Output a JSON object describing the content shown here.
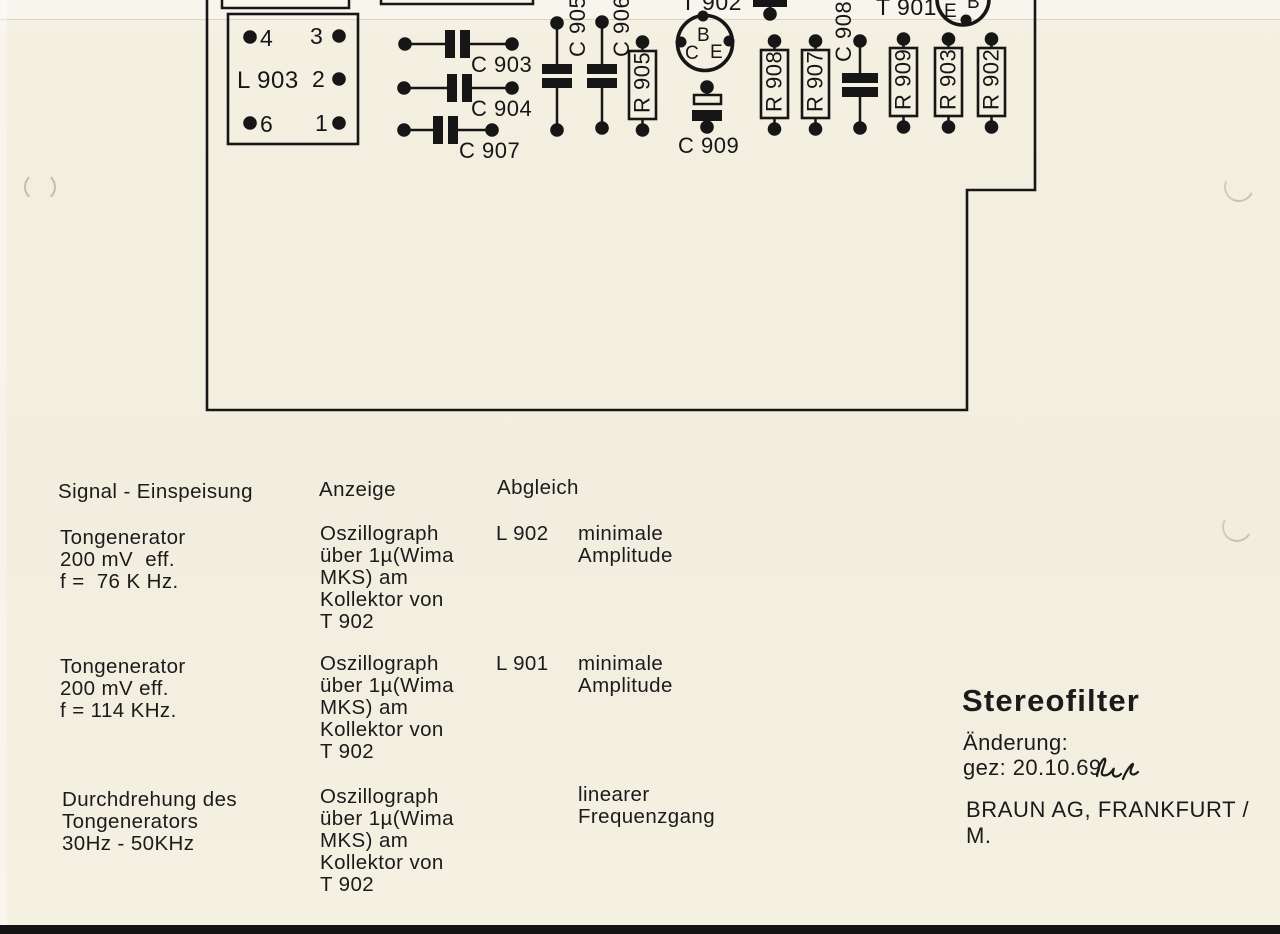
{
  "page": {
    "background": "#f2eedf",
    "ink": "#161616",
    "bottom_bar": "#131313",
    "crease": "#ddd6bf"
  },
  "board": {
    "outline_points": "207,0 207,410 967,410 967,190 1035,190 1035,0",
    "partial_boxes": [
      {
        "x1": 222,
        "y": 8,
        "x2": 349
      },
      {
        "x1": 381,
        "y": 4,
        "x2": 533
      }
    ],
    "connector": {
      "label": "L 903",
      "box": {
        "x": 228,
        "y": 14,
        "w": 130,
        "h": 130
      },
      "label_pos": {
        "x": 237,
        "y": 88
      },
      "pins": [
        {
          "num": "4",
          "dot": [
            250,
            37
          ],
          "text": [
            260,
            46
          ]
        },
        {
          "num": "3",
          "dot": [
            339,
            36
          ],
          "text": [
            310,
            44
          ]
        },
        {
          "num": "2",
          "dot": [
            339,
            79
          ],
          "text": [
            312,
            87
          ]
        },
        {
          "num": "6",
          "dot": [
            250,
            123
          ],
          "text": [
            260,
            132
          ]
        },
        {
          "num": "1",
          "dot": [
            339,
            123
          ],
          "text": [
            315,
            131
          ]
        }
      ]
    },
    "caps_horizontal": [
      {
        "label": "C 903",
        "y": 44,
        "dot_left": 405,
        "dot_right": 512,
        "bar_x": 445,
        "text": [
          471,
          72
        ]
      },
      {
        "label": "C 904",
        "y": 88,
        "dot_left": 404,
        "dot_right": 512,
        "bar_x": 447,
        "text": [
          471,
          116
        ]
      },
      {
        "label": "C 907",
        "y": 130,
        "dot_left": 404,
        "dot_right": 492,
        "bar_x": 433,
        "text": [
          459,
          158
        ]
      }
    ],
    "caps_vertical": [
      {
        "label": "C 905",
        "x": 557,
        "y_top": 23,
        "y_bottom": 130,
        "bar_y": 64,
        "bar_w": 30,
        "text": [
          585,
          57
        ]
      },
      {
        "label": "C 906",
        "x": 602,
        "y_top": 22,
        "y_bottom": 128,
        "bar_y": 64,
        "bar_w": 30,
        "text": [
          629,
          57
        ]
      },
      {
        "label": "C 908",
        "x": 860,
        "y_top": 41,
        "y_bottom": 128,
        "bar_y": 73,
        "bar_w": 36,
        "text": [
          851,
          62
        ]
      }
    ],
    "resistors": [
      {
        "label": "R 905",
        "x": 629,
        "y": 51
      },
      {
        "label": "R 908",
        "x": 761,
        "y": 50
      },
      {
        "label": "R 907",
        "x": 802,
        "y": 50
      },
      {
        "label": "R 909",
        "x": 890,
        "y": 48
      },
      {
        "label": "R 903",
        "x": 935,
        "y": 48
      },
      {
        "label": "R 902",
        "x": 978,
        "y": 48
      }
    ],
    "transistors": [
      {
        "label": "T 902",
        "label_pos": [
          681,
          10
        ],
        "center": [
          705,
          43
        ],
        "r": 27.5,
        "letters": [
          {
            "t": "B",
            "x": 697,
            "y": 41
          },
          {
            "t": "C",
            "x": 685,
            "y": 59
          },
          {
            "t": "E",
            "x": 710,
            "y": 58
          }
        ],
        "notches": [
          [
            703,
            16
          ],
          [
            681,
            42
          ],
          [
            729,
            41
          ]
        ]
      },
      {
        "label": "T 901",
        "label_pos": [
          876,
          15
        ],
        "center": [
          963,
          -1
        ],
        "r": 26,
        "letters": [
          {
            "t": "E",
            "x": 944,
            "y": 17
          },
          {
            "t": "B",
            "x": 967,
            "y": 8
          }
        ],
        "notches": [
          [
            966,
            20
          ]
        ]
      }
    ],
    "cap_polarized": {
      "label": "C 909",
      "x": 707,
      "y_top": 87,
      "y_bottom": 127,
      "text": [
        678,
        153
      ]
    },
    "stub": {
      "x": 770,
      "dot_y": 14
    }
  },
  "table": {
    "headers": {
      "signal": "Signal - Einspeisung",
      "anzeige": "Anzeige",
      "abgleich": "Abgleich"
    },
    "rows": [
      {
        "signal": "Tongenerator\n200 mV  eff.\nf =  76 K Hz.",
        "anzeige": "Oszillograph\nüber 1µ(Wima\nMKS) am\nKollektor von\nT 902",
        "ref": "L 902",
        "result": "minimale\nAmplitude"
      },
      {
        "signal": "Tongenerator\n200 mV eff.\nf = 114 KHz.",
        "anzeige": "Oszillograph\nüber 1µ(Wima\nMKS) am\nKollektor von\nT 902",
        "ref": "L 901",
        "result": "minimale\nAmplitude"
      },
      {
        "signal": "Durchdrehung des\nTongenerators\n30Hz - 50KHz",
        "anzeige": "Oszillograph\nüber 1µ(Wima\nMKS) am\nKollektor von\nT 902",
        "ref": "",
        "result": "linearer\nFrequenzgang"
      }
    ]
  },
  "title_block": {
    "title": "Stereofilter",
    "change_label": "Änderung:",
    "signed": "gez: 20.10.69",
    "company": "BRAUN AG, FRANKFURT / M."
  }
}
